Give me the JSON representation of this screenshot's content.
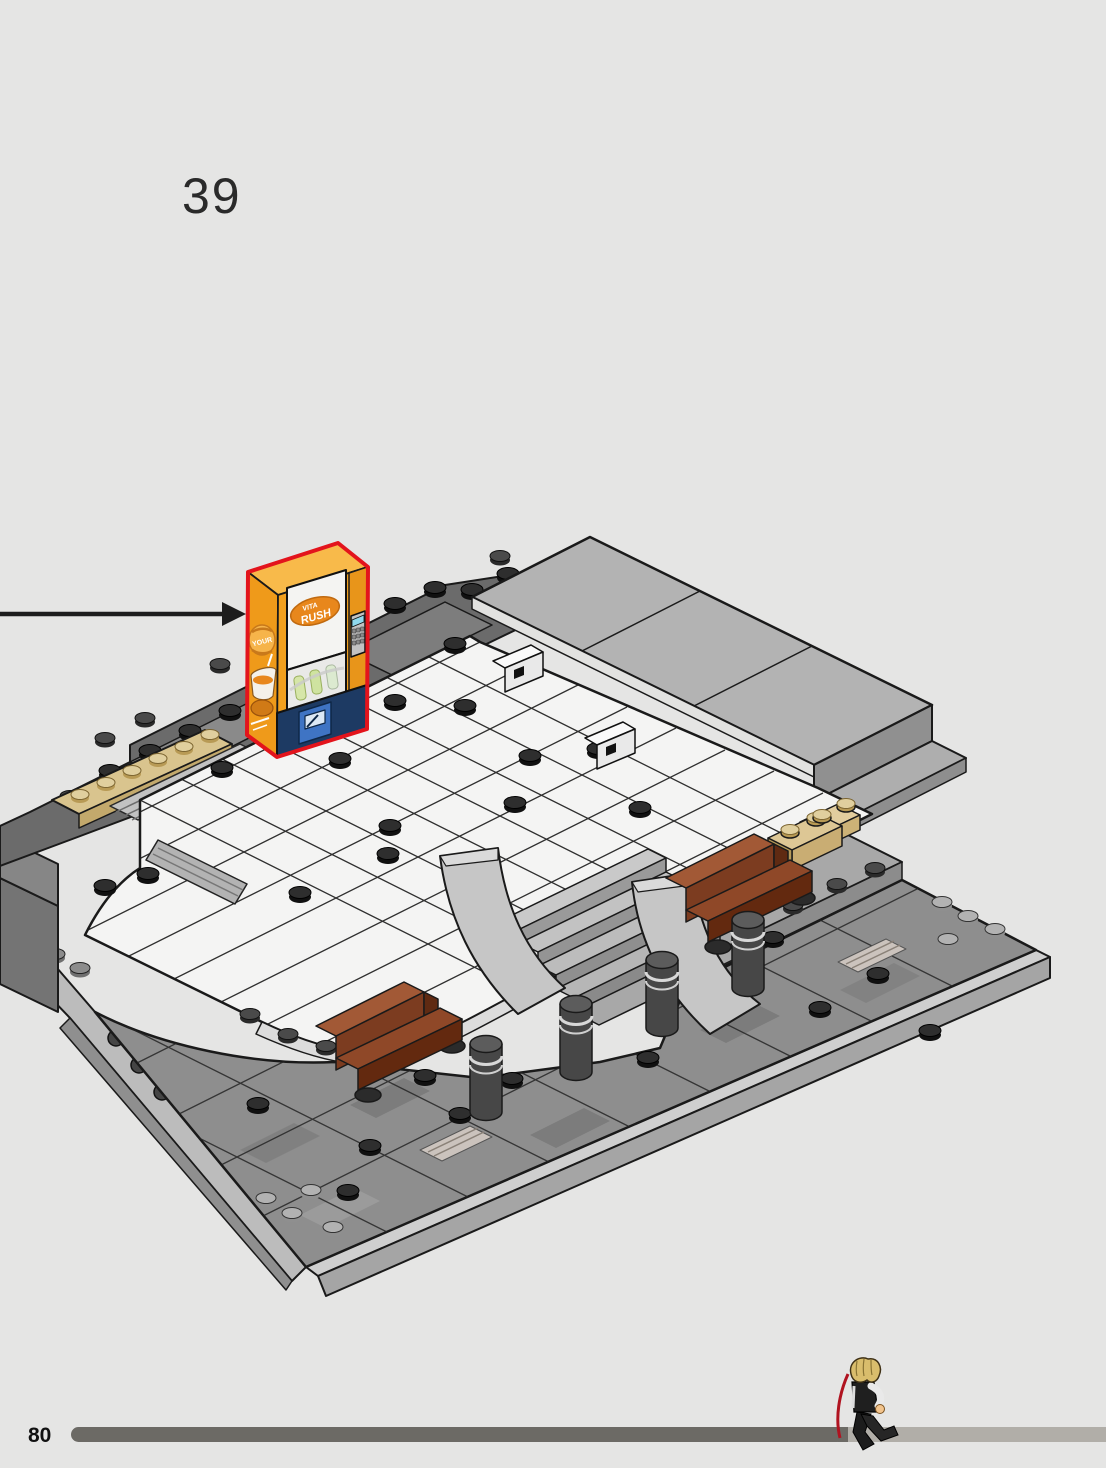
{
  "page": {
    "background_color": "#e5e5e4",
    "step_number": "39",
    "page_number": "80"
  },
  "callout": {
    "arrow_direction": "right",
    "arrow_color": "#1d1d1d",
    "highlight_outline_color": "#e3141c"
  },
  "vending_machine": {
    "brand_line1": "VITA",
    "brand_line2": "RUSH",
    "side_visible_word": "YOUR",
    "body_color": "#f2a01e",
    "base_color": "#1d3a63"
  },
  "scene": {
    "palette": {
      "white_tile": "#f4f4f3",
      "roof_gray": "#b3b3b3",
      "plaza_gray": "#8e8e8e",
      "wall_dark_gray": "#6b6b6b",
      "bench_brown": "#8a4426",
      "tan_brick": "#d9c48e",
      "bollard_gray": "#474747",
      "baseplate_edge": "#bcbcbc"
    },
    "elements": [
      "roof-plate",
      "white-tile-floor",
      "dark-wall",
      "tan-plate-strip",
      "grates",
      "stairs",
      "benches",
      "bollards",
      "tan-bricks",
      "plaza",
      "baseplate-edges",
      "vending-machine"
    ]
  },
  "progress": {
    "fraction": 0.7,
    "bar_filled_color": "#6c6a65",
    "bar_remaining_color": "#b1aea8"
  }
}
